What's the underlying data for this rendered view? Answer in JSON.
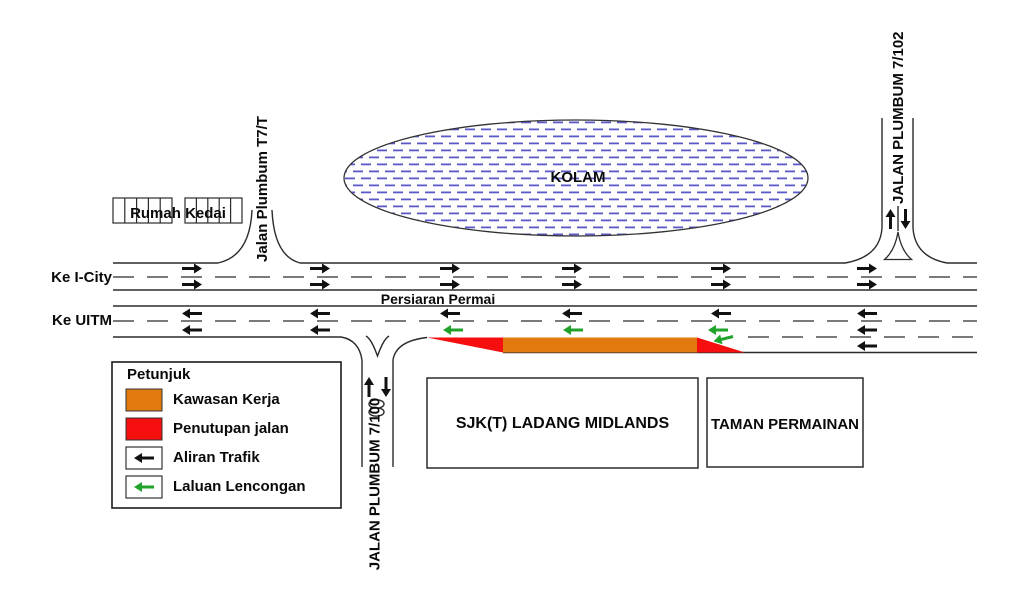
{
  "map": {
    "pond_label": "KOLAM",
    "shophouses_label": "Rumah Kedai",
    "school_label": "SJK(T) LADANG MIDLANDS",
    "playground_label": "TAMAN PERMAINAN",
    "main_road_label": "Persiaran Permai",
    "dest_east": "Ke I-City",
    "dest_west": "Ke UITM",
    "road_north_left": "Jalan Plumbum T7/T",
    "road_north_right": "JALAN PLUMBUM 7/102",
    "road_south": "JALAN PLUMBUM 7/100"
  },
  "legend": {
    "title": "Petunjuk",
    "items": [
      {
        "label": "Kawasan Kerja",
        "type": "work-area-swatch"
      },
      {
        "label": "Penutupan jalan",
        "type": "closure-swatch"
      },
      {
        "label": "Aliran Trafik",
        "type": "traffic-arrow"
      },
      {
        "label": "Laluan Lencongan",
        "type": "diversion-arrow"
      }
    ]
  },
  "colors": {
    "work_area": "#E2790F",
    "closure": "#F50F0F",
    "traffic": "#111111",
    "diversion": "#1FA32A",
    "pond_line": "#5A5AC6",
    "road_edge": "#2B2B2B",
    "lane_dash": "#7A7A7A"
  }
}
